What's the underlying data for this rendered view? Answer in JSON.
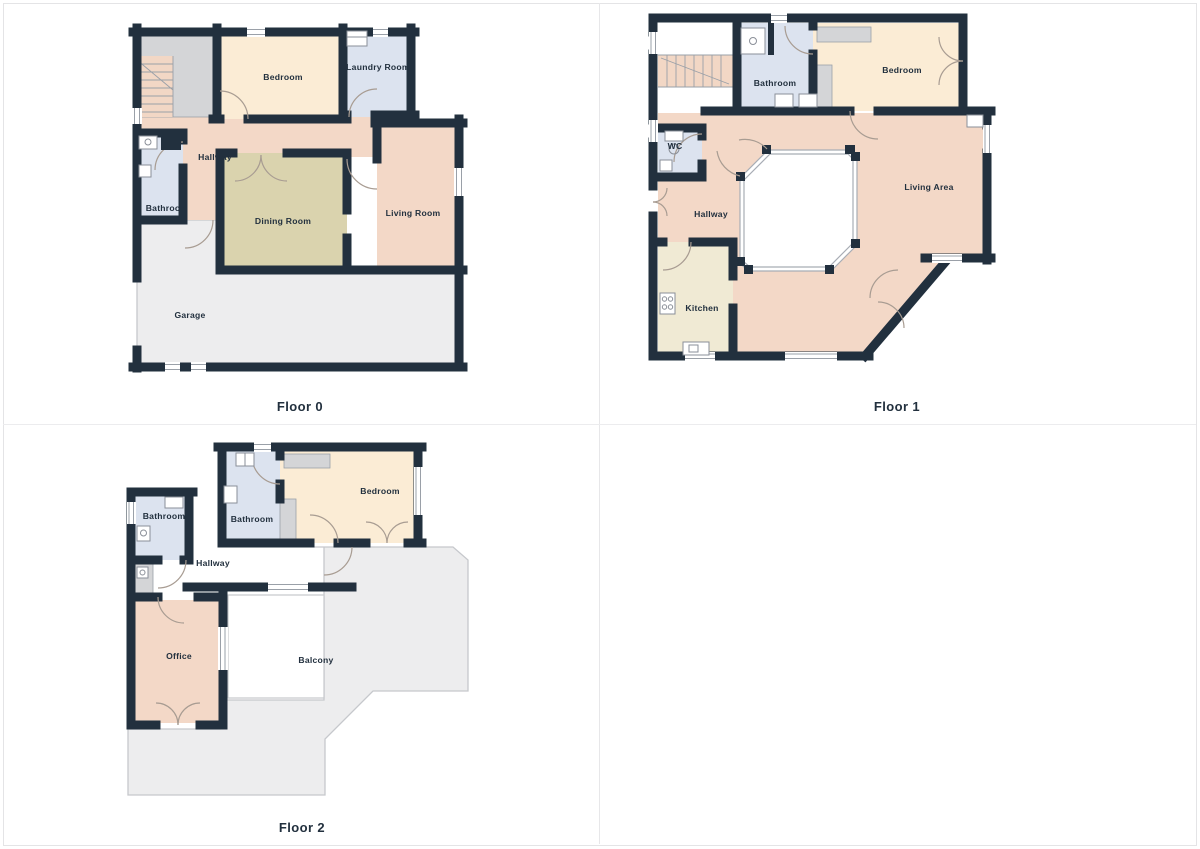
{
  "document": {
    "type": "floor-plan-sheet",
    "background": "#ffffff"
  },
  "palette": {
    "wall": "#22303e",
    "bedroom_fill": "#fbecd5",
    "bathroom_fill": "#dce3ef",
    "hallway_fill": "#f3d8c7",
    "dining_fill": "#dad3ae",
    "kitchen_fill": "#f0ead4",
    "outdoor_fill": "#ededee",
    "closet_fill": "#d4d5d7",
    "outline": "#c6c8cc",
    "label_text": "#22303e"
  },
  "floors": [
    {
      "title": "Floor 0",
      "rooms": {
        "bedroom": "Bedroom",
        "laundry": "Laundry Room",
        "hallway": "Hallway",
        "bathroom": "Bathroom",
        "dining": "Dining Room",
        "living": "Living Room",
        "garage": "Garage"
      }
    },
    {
      "title": "Floor 1",
      "rooms": {
        "bathroom": "Bathroom",
        "bedroom": "Bedroom",
        "wc": "WC",
        "hallway": "Hallway",
        "kitchen": "Kitchen",
        "living": "Living Area"
      }
    },
    {
      "title": "Floor 2",
      "rooms": {
        "bathroom_left": "Bathroom",
        "bathroom_center": "Bathroom",
        "bedroom": "Bedroom",
        "hallway": "Hallway",
        "office": "Office",
        "balcony": "Balcony"
      }
    }
  ]
}
